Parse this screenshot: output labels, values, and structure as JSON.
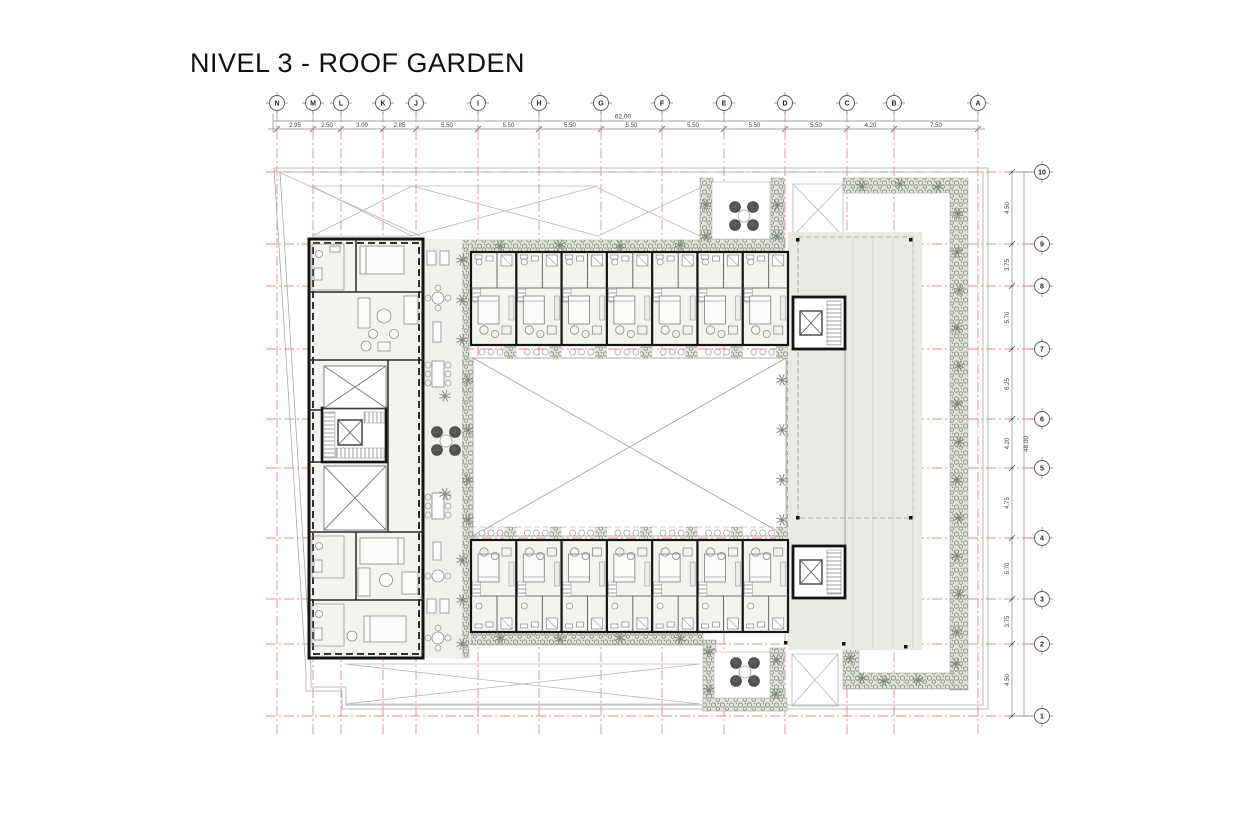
{
  "title": "NIVEL 3 - ROOF GARDEN",
  "colors": {
    "grid_red": "#e07a7a",
    "wall_black": "#141414",
    "vegetation_gray": "#82877b",
    "terrace_gray": "#e9e9e6",
    "room_gray": "#f3f3f0"
  },
  "grid": {
    "columns": {
      "labels": [
        "N",
        "M",
        "L",
        "K",
        "J",
        "I",
        "H",
        "G",
        "F",
        "E",
        "D",
        "C",
        "B",
        "A"
      ],
      "dims": [
        "2.95",
        "2.50",
        "3.00",
        "2.85",
        "5.50",
        "5.50",
        "5.50",
        "5.50",
        "5.50",
        "5.50",
        "5.50",
        "4.20",
        "7.50"
      ],
      "total": "62.00"
    },
    "rows": {
      "labels": [
        "10",
        "9",
        "8",
        "7",
        "6",
        "5",
        "4",
        "3",
        "2",
        "1"
      ],
      "dims": [
        "4.50",
        "3.75",
        "5.70",
        "6.25",
        "4.20",
        "4.75",
        "5.70",
        "3.75",
        "4.50"
      ],
      "total": "48.00"
    }
  },
  "plan": {
    "top_room_band": {
      "unit_count": 7
    },
    "bottom_room_band": {
      "unit_count": 7
    },
    "balcony_tables_per_unit": 3
  }
}
